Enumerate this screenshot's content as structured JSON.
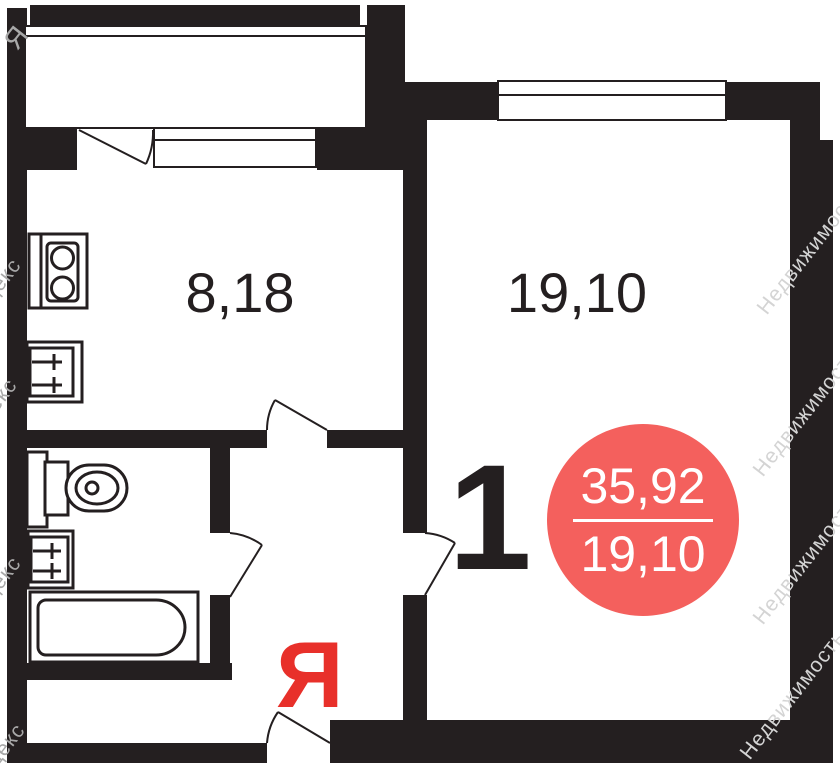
{
  "floorplan": {
    "kitchen": {
      "area": "8,18"
    },
    "living_room": {
      "area": "19,10",
      "room_number": "1"
    },
    "area_badge": {
      "total_area": "35,92",
      "living_area": "19,10"
    },
    "logo": {
      "letter": "Я"
    },
    "watermarks": {
      "left": [
        {
          "text": "Я"
        },
        {
          "text": "Яндекс"
        },
        {
          "text": "Яндекс"
        },
        {
          "text": "Яндекс"
        },
        {
          "text": "Яндекс"
        }
      ],
      "right": [
        {
          "text": "Недвижимость"
        },
        {
          "text": "Недвижимость"
        },
        {
          "text": "Недвижимость"
        },
        {
          "text": "Недвижимость"
        }
      ]
    },
    "colors": {
      "wall": "#241f20",
      "badge": "#f4605d",
      "logo_red": "#e8302a"
    }
  }
}
